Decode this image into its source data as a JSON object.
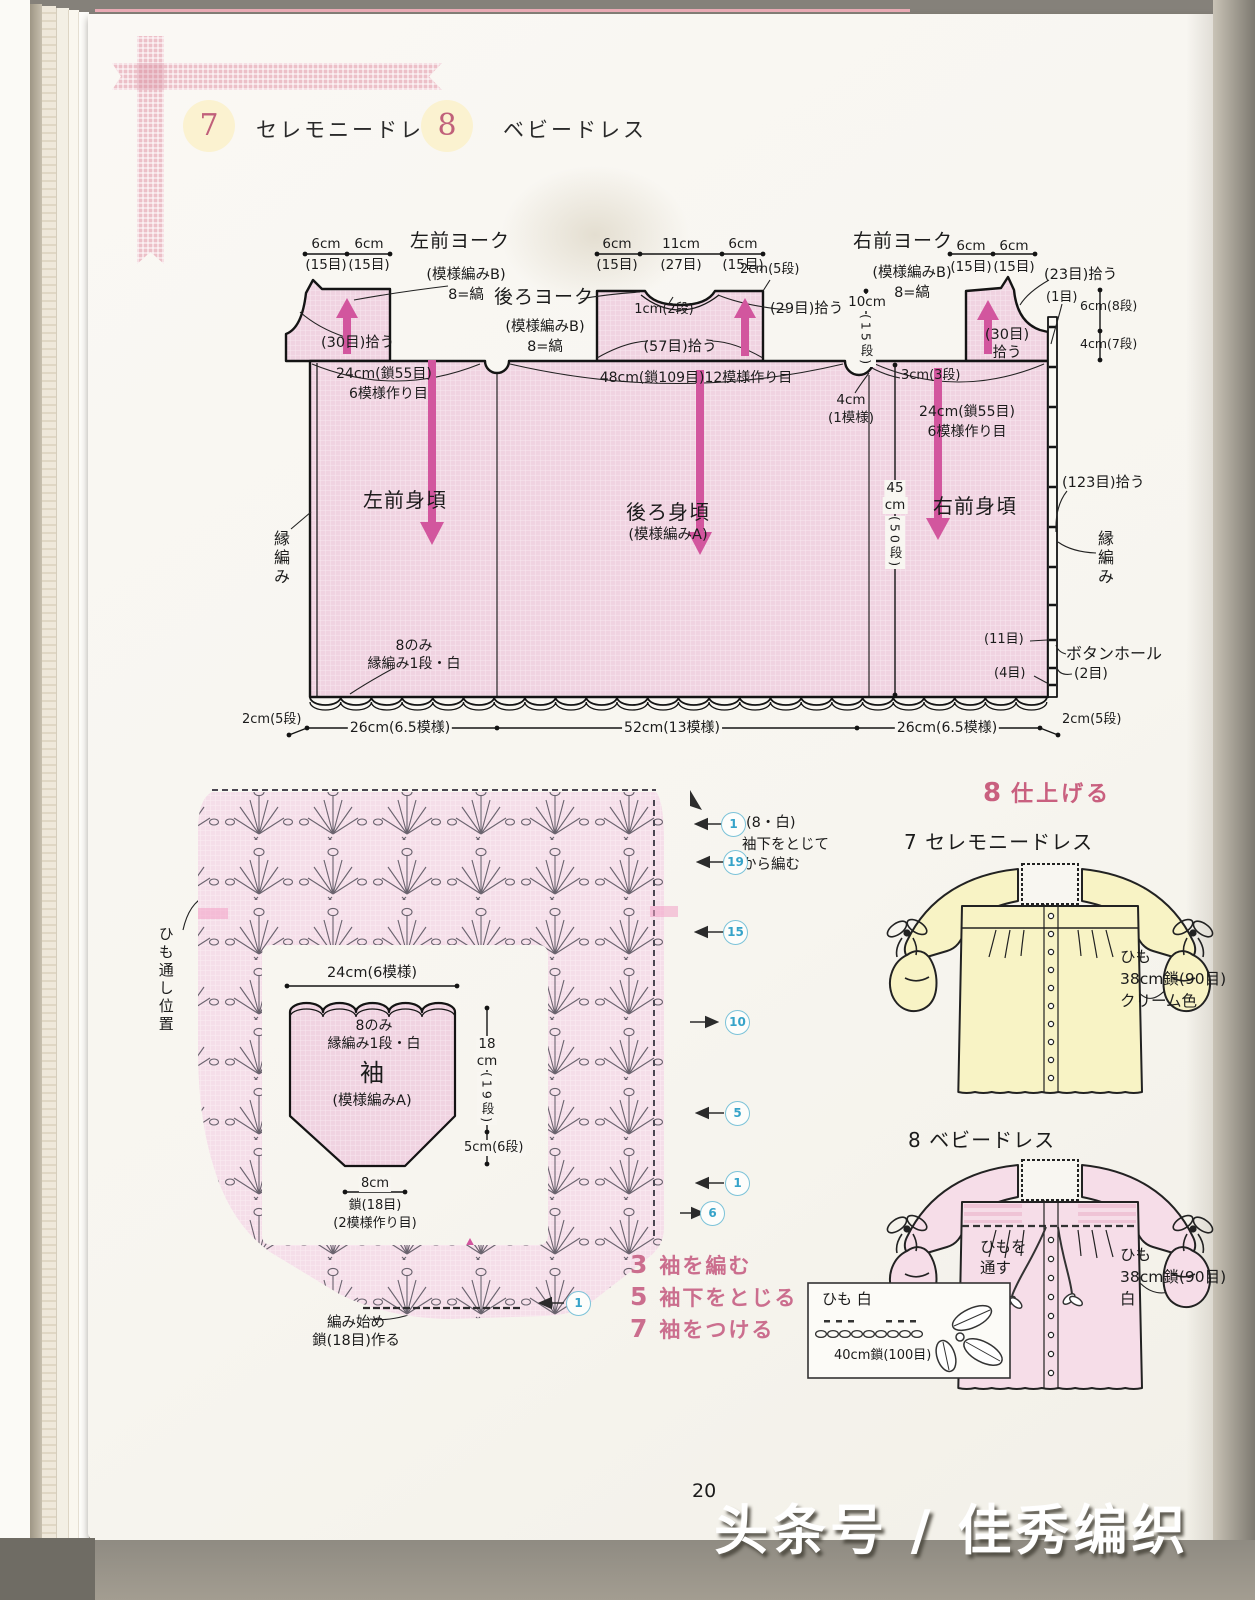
{
  "header": {
    "n7": "7",
    "t7": "セレモニードレス",
    "n8": "8",
    "t8": "ベビードレス"
  },
  "colors": {
    "fabric_pink": "#f0d3e1",
    "accent_magenta": "#d2569e",
    "heading_pink": "#c9607f",
    "badge_yellow": "#fbf2d0",
    "badge_number": "#c0607a",
    "circled_blue": "#36a3c9",
    "dress_yellow": "#f8f3c5",
    "dress_pink": "#f6dde8"
  },
  "sch": {
    "ly": {
      "t": "左前ヨーク",
      "p": "(模様編みB)",
      "s": "8=縞",
      "d1": "6cm",
      "d2": "6cm",
      "s1": "(15目)",
      "s2": "(15目)",
      "pick": "(30目)拾う",
      "co": "24cm(鎖55目)",
      "co2": "6模様作り目"
    },
    "by": {
      "t": "後ろヨーク",
      "p": "(模様編みB)",
      "s": "8=縞",
      "d1": "6cm",
      "d2": "11cm",
      "d3": "6cm",
      "s1": "(15目)",
      "s2": "(27目)",
      "s3": "(15目)",
      "neck": "1cm(2段)",
      "rows": "2cm(5段)",
      "pick": "(29目)拾う",
      "pick2": "(57目)拾う",
      "co": "48cm(鎖109目)12模様作り目"
    },
    "ry": {
      "t": "右前ヨーク",
      "p": "(模様編みB)",
      "s": "8=縞",
      "d1": "6cm",
      "d2": "6cm",
      "s1": "(15目)",
      "s2": "(15目)",
      "pickn": "(23目)拾う",
      "one": "(1目)",
      "r8": "6cm(8段)",
      "r7": "4cm(7段)",
      "pick1": "(30目)",
      "pick2": "拾う",
      "slit": "3cm(3段)",
      "co": "24cm(鎖55目)",
      "co2": "6模様作り目"
    },
    "mid": {
      "h1": "10cm",
      "h2": "(15段)",
      "ua": "4cm",
      "ua2": "(1模様)"
    },
    "body": {
      "l": "左前身頃",
      "b": "後ろ身頃",
      "bp": "(模様編みA)",
      "r": "右前身頃",
      "h45": "45",
      "hcm": "cm",
      "h50": "(50段)",
      "edgeL": "縁編み",
      "edgeR": "縁編み",
      "pick": "(123目)拾う",
      "hem1": "8のみ",
      "hem2": "縁編み1段・白",
      "bh": "ボタンホール",
      "bh2": "(2目)",
      "m11": "(11目)",
      "m4": "(4目)"
    },
    "hem": {
      "e1": "2cm(5段)",
      "w1": "26cm(6.5模様)",
      "w2": "52cm(13模様)",
      "w3": "26cm(6.5模様)",
      "e2": "2cm(5段)"
    }
  },
  "chart": {
    "pos": "ひも通し位置",
    "n1": "(8・白)",
    "n2": "袖下をとじて",
    "n3": "から編む",
    "r": [
      "1",
      "19",
      "15",
      "10",
      "5",
      "1",
      "6",
      "1"
    ],
    "slv": {
      "w": "24cm(6模様)",
      "a": "8のみ",
      "b": "縁編み1段・白",
      "t": "袖",
      "p": "(模様編みA)",
      "h18": "18",
      "hcm": "cm",
      "h19": "(19段)",
      "c5": "5cm(6段)",
      "w8": "8cm",
      "ch": "鎖(18目)",
      "ch2": "(2模様作り目)",
      "st1": "編み始め",
      "st2": "鎖(18目)作る"
    },
    "steps": [
      {
        "n": "3",
        "t": "袖を編む"
      },
      {
        "n": "5",
        "t": "袖下をとじる"
      },
      {
        "n": "7",
        "t": "袖をつける"
      }
    ]
  },
  "fin": {
    "hn": "8",
    "ht": "仕上げる",
    "t7": "7 セレモニードレス",
    "y1": "ひも",
    "y2": "38cm鎖(90目)",
    "y3": "クリーム色",
    "t8": "8 ベビードレス",
    "th1": "ひもを",
    "th2": "通す",
    "p1": "ひも",
    "p2": "38cm鎖(90目)",
    "p3": "白",
    "bx1": "ひも 白",
    "bx2": "40cm鎖(100目)"
  },
  "footer": {
    "pg": "20",
    "wm": "头条号 / 佳秀编织"
  }
}
